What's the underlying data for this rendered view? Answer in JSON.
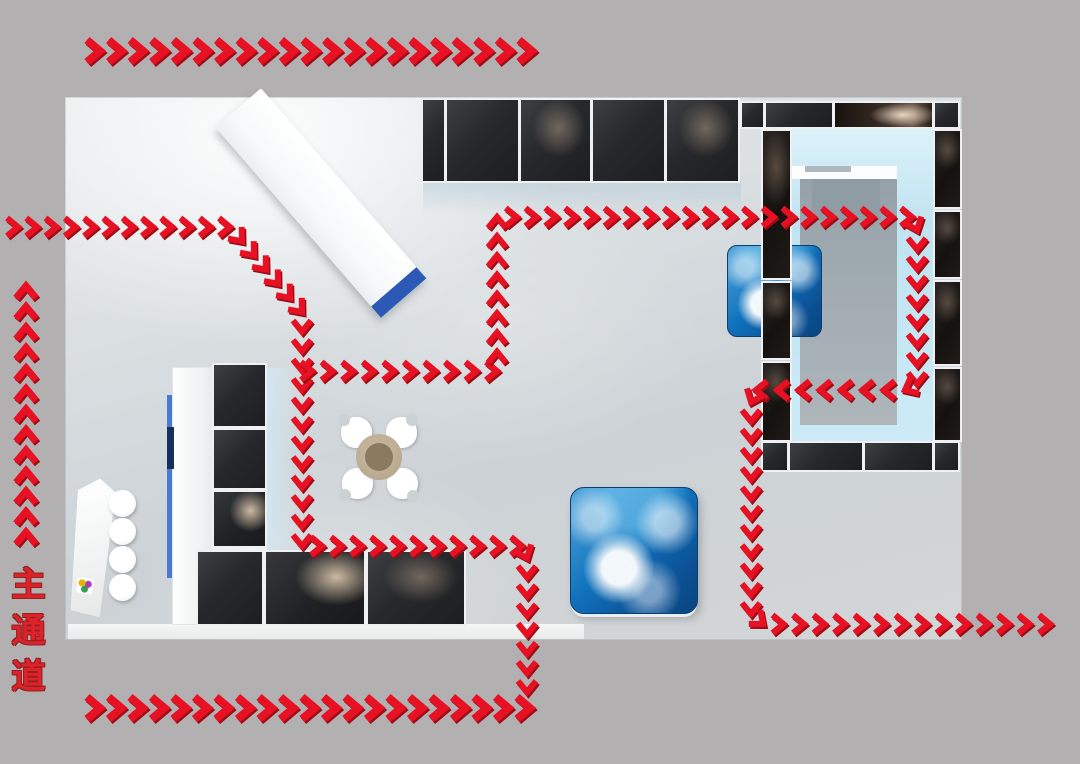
{
  "labels": {
    "main_aisle": "主通道"
  },
  "colors": {
    "background_gray": "#b2b0b1",
    "arrow_red": "#e81023",
    "arrow_red_dark": "#9c0d15",
    "aisle_text_red": "#e02128",
    "accent_blue": "#2b59b5",
    "glow_blue": "#c4e7f3",
    "screen_blue": "#1173bd",
    "panel_dark": "#26282b",
    "table_wood_tan": "#b1a088"
  },
  "flow_paths": [
    {
      "name": "entry-top-banner",
      "direction": "right",
      "spacing": 21.6,
      "stroke": 8,
      "size": {
        "depth": 13,
        "half": 11
      },
      "points": [
        [
          100,
          51
        ],
        [
          532,
          51
        ]
      ]
    },
    {
      "name": "main-left-route",
      "direction": "in-and-down",
      "spacing": 20,
      "stroke": 6,
      "size": {
        "depth": 11,
        "half": 9
      },
      "points": [
        [
          18,
          227
        ],
        [
          230,
          227
        ],
        [
          302,
          312
        ],
        [
          302,
          546
        ],
        [
          522,
          546
        ],
        [
          527,
          558
        ],
        [
          527,
          692
        ]
      ]
    },
    {
      "name": "inner-loop-route",
      "direction": "clockwise",
      "spacing": 20,
      "stroke": 6,
      "size": {
        "depth": 11,
        "half": 9
      },
      "points": [
        [
          312,
          371
        ],
        [
          497,
          371
        ],
        [
          497,
          217
        ],
        [
          912,
          217
        ],
        [
          917,
          230
        ],
        [
          917,
          384
        ],
        [
          905,
          390
        ],
        [
          756,
          390
        ],
        [
          751,
          402
        ],
        [
          751,
          614
        ],
        [
          763,
          624
        ],
        [
          1050,
          624
        ]
      ]
    },
    {
      "name": "exit-bottom-banner",
      "direction": "right",
      "spacing": 21.6,
      "stroke": 8,
      "size": {
        "depth": 13,
        "half": 11
      },
      "points": [
        [
          100,
          708
        ],
        [
          530,
          708
        ]
      ]
    },
    {
      "name": "main-aisle-direction",
      "direction": "up",
      "spacing": 21,
      "stroke": 7,
      "size": {
        "depth": 12,
        "half": 10
      },
      "points": [
        [
          26,
          532
        ],
        [
          26,
          286
        ]
      ]
    }
  ]
}
